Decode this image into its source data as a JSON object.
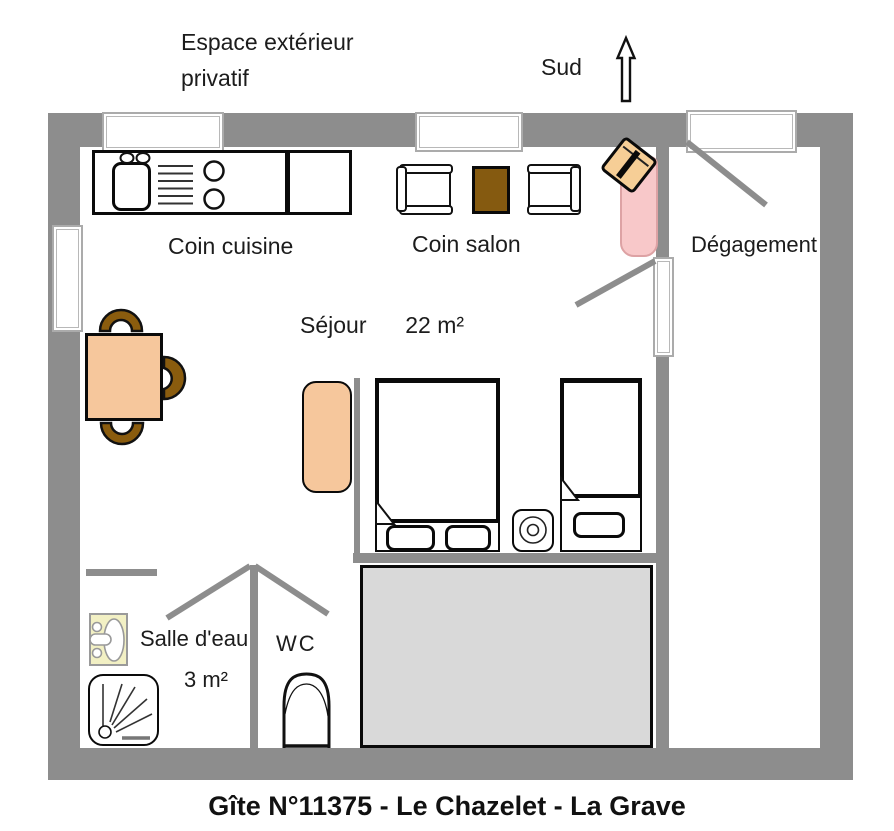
{
  "title": "Gîte N°11375 - Le Chazelet - La Grave",
  "annotations": {
    "exterior_line1": "Espace extérieur",
    "exterior_line2": "privatif",
    "compass_label": "Sud"
  },
  "rooms": {
    "kitchen": {
      "label": "Coin cuisine"
    },
    "salon": {
      "label": "Coin salon"
    },
    "sejour": {
      "label": "Séjour",
      "area": "22 m²"
    },
    "degagement": {
      "label": "Dégagement"
    },
    "salle_eau": {
      "label": "Salle d'eau",
      "area": "3 m²"
    },
    "wc": {
      "label": "WC"
    }
  },
  "colors": {
    "wall_gray": "#8d8d8d",
    "window_frame_gray": "#ababab",
    "furniture_peach": "#f6c79c",
    "chair_brown": "#8a5c0e",
    "coffee_table_brown": "#855a10",
    "lounger_pink": "#f8c8c9",
    "stove_tan": "#f6ce96",
    "washbasin_yellow": "#f2f0c4",
    "floor_zone_gray": "#d9d9d9"
  }
}
